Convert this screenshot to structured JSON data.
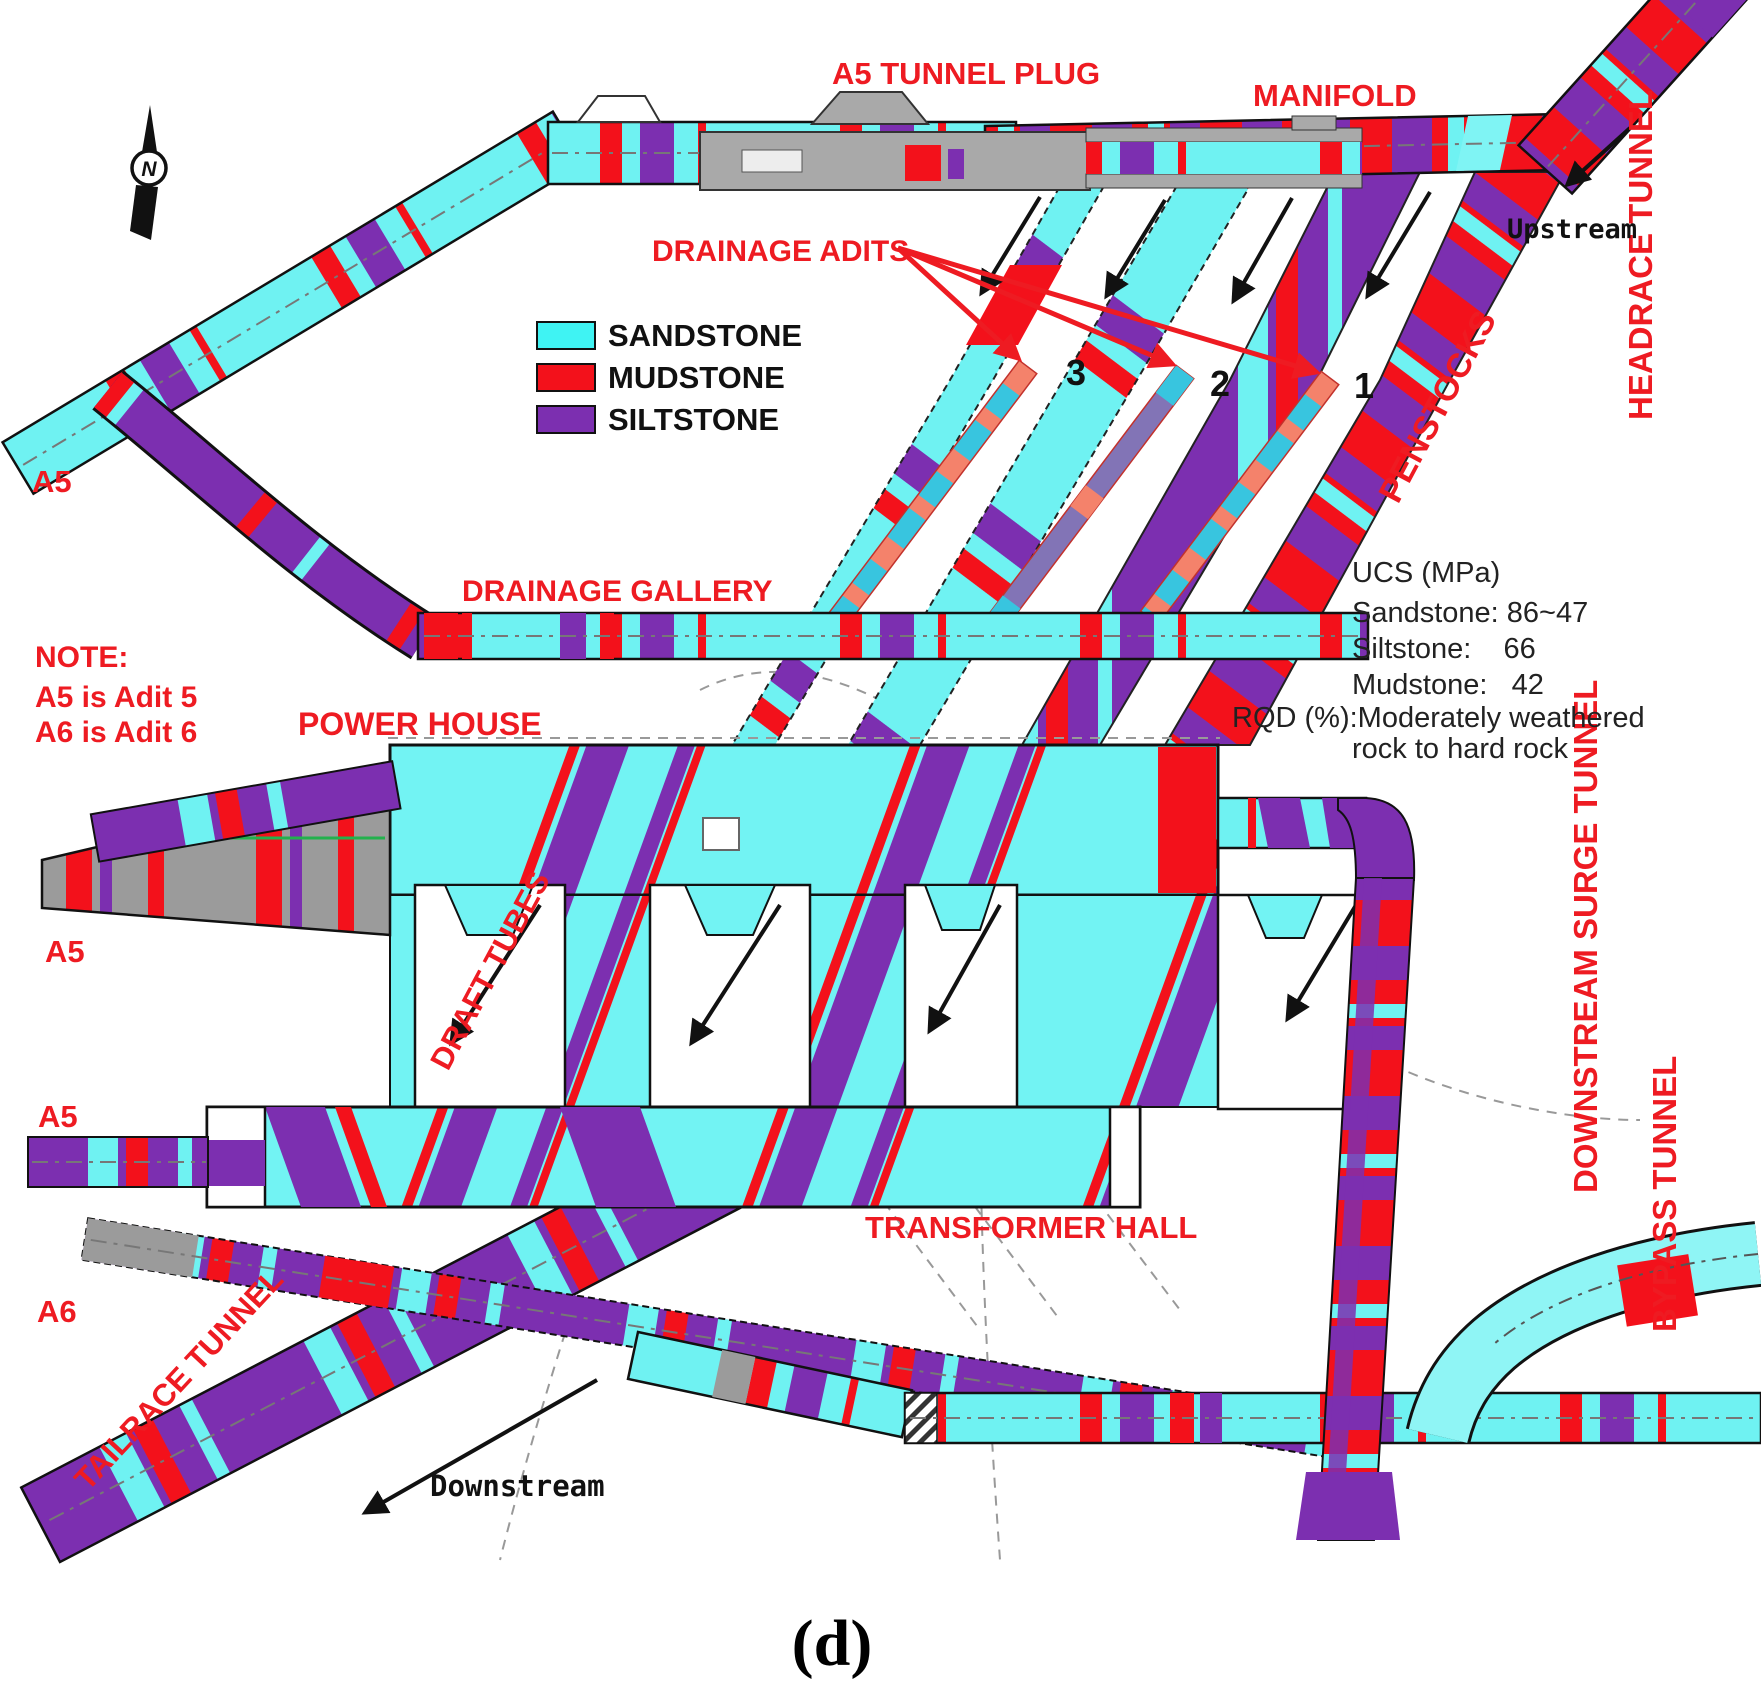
{
  "diagram": {
    "caption": "(d)",
    "compass_letter": "N",
    "legend": {
      "items": [
        {
          "label": "SANDSTONE",
          "color": "#3FF3F3"
        },
        {
          "label": "MUDSTONE",
          "color": "#F3111B"
        },
        {
          "label": "SILTSTONE",
          "color": "#7C2FB0"
        }
      ]
    },
    "labels": {
      "a5_tunnel_plug": "A5 TUNNEL PLUG",
      "manifold": "MANIFOLD",
      "headrace_tunnel": "HEADRACE TUNNEL",
      "upstream": "Upstream",
      "drainage_adits": "DRAINAGE ADITS",
      "penstocks": "PENSTOCKS",
      "drainage_gallery": "DRAINAGE GALLERY",
      "power_house": "POWER HOUSE",
      "draft_tubes": "DRAFT TUBES",
      "transformer_hall": "TRANSFORMER HALL",
      "downstream_surge_tunnel": "DOWNSTREAM SURGE TUNNEL",
      "bypass_tunnel": "BYPASS TUNNEL",
      "tailrace_tunnel": "TAILRACE TUNNEL",
      "downstream": "Downstream",
      "a5": "A5",
      "a6": "A6"
    },
    "note": {
      "line1": "NOTE:",
      "line2": "A5 is Adit 5",
      "line3": "A6 is Adit 6"
    },
    "rock_info": {
      "line1": "UCS (MPa)",
      "line2": "Sandstone: 86~47",
      "line3": "Siltstone:    66",
      "line4": "Mudstone:   42",
      "line5": "RQD (%):Moderately weathered",
      "line6": "rock to hard rock"
    },
    "adit_numbers": [
      "3",
      "2",
      "1"
    ],
    "colors": {
      "sandstone": "#3FF3F3",
      "mudstone": "#F3111B",
      "siltstone": "#7C2FB0",
      "tunnel_cyan": "#6FF2F2",
      "adit_teal": "#38C5DF",
      "adit_salmon": "#F4826B",
      "concrete_gray": "#9B9B9B",
      "label_red": "#EE1B22"
    }
  }
}
